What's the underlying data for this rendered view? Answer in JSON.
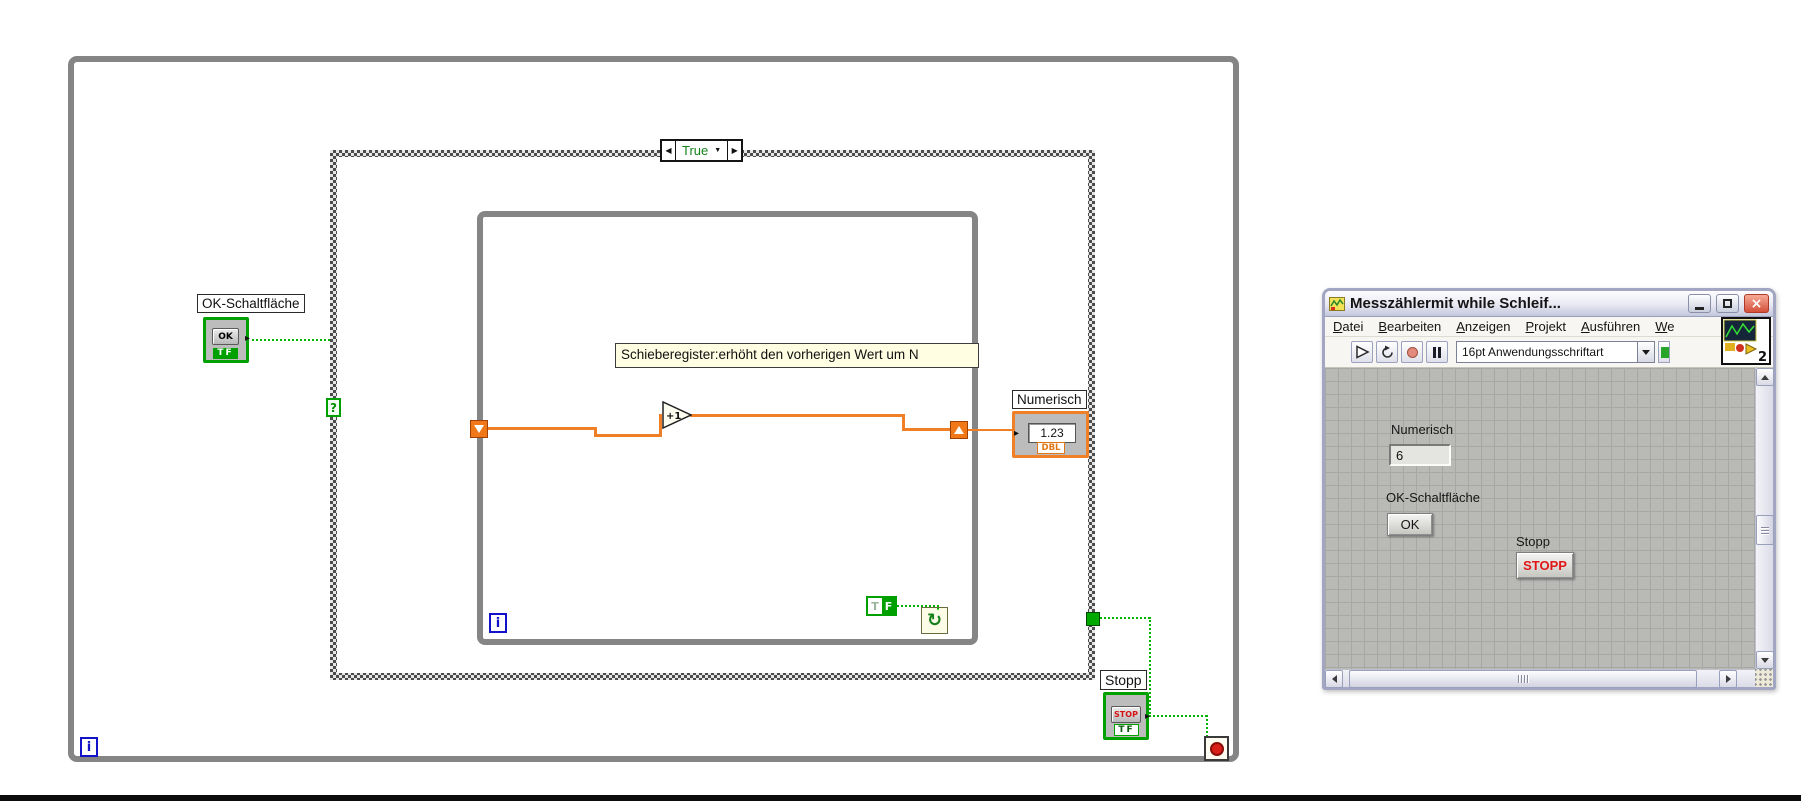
{
  "block_diagram": {
    "case_selector_value": "True",
    "selector_terminal": "?",
    "ok_control": {
      "label": "OK-Schaltfläche",
      "glyph": "OK",
      "type": "TF"
    },
    "comment": "Schieberegister:erhöht den vorherigen Wert um N",
    "increment": "+1",
    "numeric_indicator": {
      "label": "Numerisch",
      "display": "1.23",
      "type": "DBL"
    },
    "false_constant": {
      "t": "T",
      "f": "F"
    },
    "inner_loop": {
      "iteration": "i"
    },
    "outer_loop": {
      "iteration": "i"
    },
    "stop_control": {
      "label": "Stopp",
      "glyph": "STOP",
      "type": "TF"
    }
  },
  "front_panel": {
    "title": "Messzählermit while Schleif...",
    "menus": [
      {
        "label": "Datei"
      },
      {
        "label": "Bearbeiten"
      },
      {
        "label": "Anzeigen"
      },
      {
        "label": "Projekt"
      },
      {
        "label": "Ausführen"
      },
      {
        "label": "We"
      }
    ],
    "toolbar": {
      "font_selector": "16pt Anwendungsschriftart"
    },
    "vi_icon_badge": "2",
    "panel": {
      "numeric_label": "Numerisch",
      "numeric_value": "6",
      "ok_label": "OK-Schaltfläche",
      "ok_button": "OK",
      "stop_label": "Stopp",
      "stop_button": "STOPP"
    }
  },
  "colors": {
    "wire_boolean": "#00B400",
    "wire_numeric": "#F08028",
    "loop_border": "#858585",
    "boolean_terminal_green": "#00A000",
    "indicator_orange": "#F08028",
    "stop_sign_red": "#D82018",
    "stop_button_text": "#E01818",
    "dbl_text": "#E07818",
    "panel_grid": "#B9B9B6"
  }
}
